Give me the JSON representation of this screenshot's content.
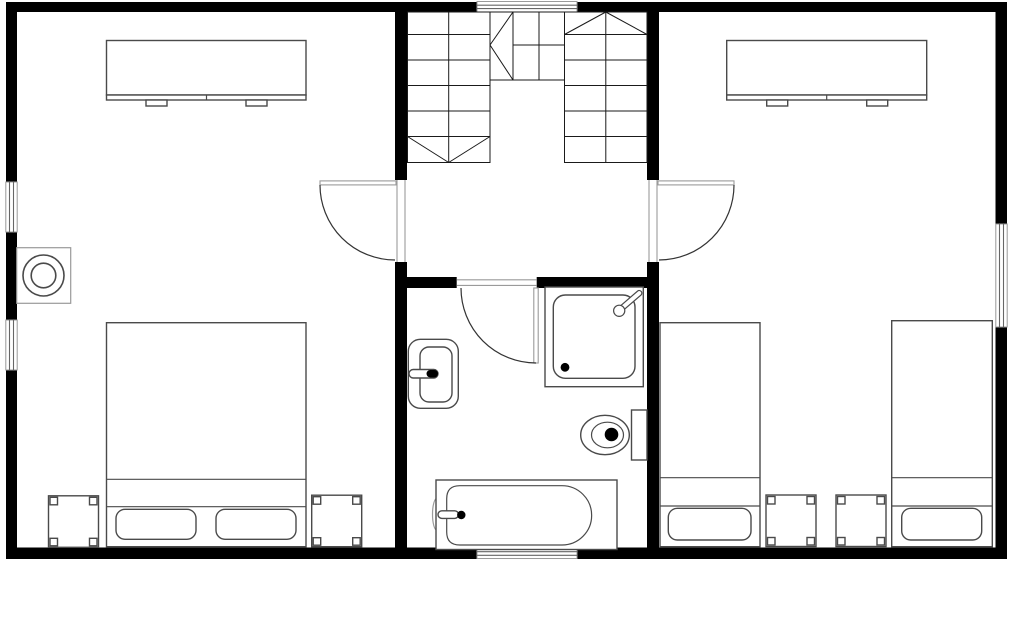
{
  "meta": {
    "title": "Upper floor plan",
    "type": "floor-plan",
    "rooms": [
      {
        "id": "bedroom-left",
        "label": "Left bedroom",
        "items": [
          "wardrobe",
          "double bed",
          "nightstand",
          "nightstand",
          "round fixture",
          "window",
          "window"
        ]
      },
      {
        "id": "stair-hall",
        "label": "Stair hall / landing",
        "items": [
          "u-shaped staircase",
          "door to left bedroom",
          "door to right bedroom",
          "window"
        ]
      },
      {
        "id": "bathroom",
        "label": "Bathroom",
        "items": [
          "washbasin",
          "shower cabin",
          "toilet",
          "bathtub",
          "door",
          "window"
        ]
      },
      {
        "id": "bedroom-right",
        "label": "Right bedroom",
        "items": [
          "wardrobe",
          "single bed",
          "single bed",
          "nightstand",
          "nightstand",
          "window"
        ]
      }
    ],
    "window_count": 5,
    "door_count": 3
  },
  "colors": {
    "floor": "#ffffff",
    "wall": "#000000",
    "stair_line": "#1a1a1a",
    "furniture_line": "#4a4a4a",
    "frame_line": "#9a9a9a",
    "door_arc": "#333333",
    "window_line": "#666666",
    "fixture_fill": "#000000"
  },
  "elements": {
    "plan": "Upper floor plan drawing",
    "walls": "Exterior and interior walls",
    "window_top": "Window, top wall above staircase",
    "window_left_upper": "Window, left wall upper",
    "window_left_lower": "Window, left wall lower",
    "window_right": "Window, right wall",
    "window_bottom": "Window, bottom wall in bathroom",
    "stairs": "U-shaped staircase with landing winders",
    "door_left": "Door between hall and left bedroom",
    "door_right": "Door between hall and right bedroom",
    "door_bath": "Bathroom door",
    "left_wardrobe": "Wardrobe, left bedroom",
    "left_fixture": "Round fixture on left wall",
    "left_bed": "Double bed with two pillows",
    "left_nightstand_a": "Nightstand left of double bed",
    "left_nightstand_b": "Nightstand right of double bed",
    "right_wardrobe": "Wardrobe, right bedroom",
    "right_bed_a": "Single bed, left",
    "right_bed_b": "Single bed, right",
    "right_nightstand_a": "Nightstand between single beds, left",
    "right_nightstand_b": "Nightstand between single beds, right",
    "sink": "Washbasin with faucet",
    "shower": "Shower cabin with hand shower and drain",
    "toilet": "Toilet with cistern",
    "bathtub": "Bathtub with faucet and drain"
  }
}
